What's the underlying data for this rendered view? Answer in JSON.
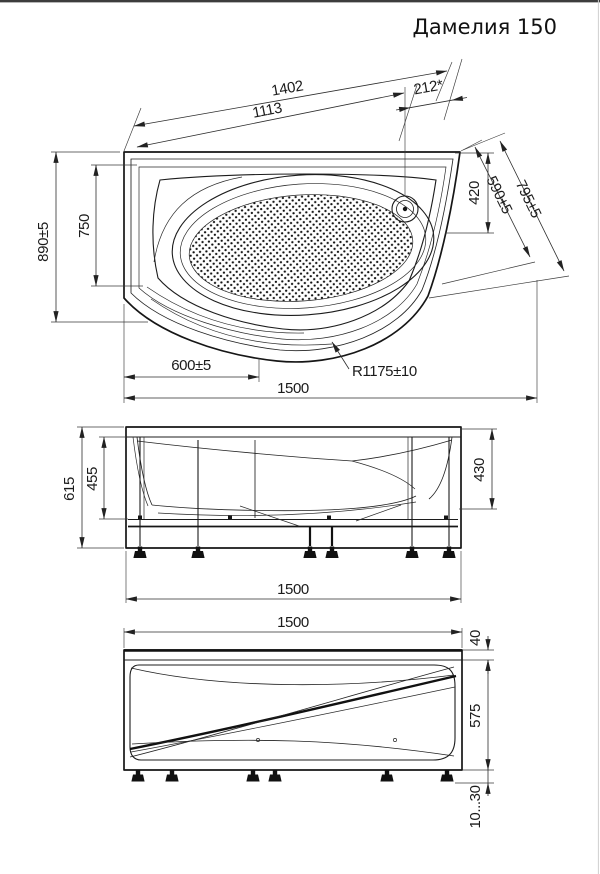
{
  "title": "Дамелия 150",
  "colors": {
    "ink": "#1c1c1c",
    "dim_line": "#2d2d2d",
    "background": "#ffffff",
    "top_border": "#3c3c3c"
  },
  "top_view": {
    "dim_1402": "1402",
    "dim_1113": "1113",
    "dim_212": "212*",
    "dim_420": "420",
    "dim_590": "590±5",
    "dim_795": "795±5",
    "dim_890": "890±5",
    "dim_750": "750",
    "dim_600": "600±5",
    "dim_1500": "1500",
    "radius_r1175": "R1175±10"
  },
  "side_view": {
    "dim_615": "615",
    "dim_455": "455",
    "dim_430": "430",
    "dim_1500": "1500"
  },
  "front_view": {
    "dim_1500": "1500",
    "dim_40": "40",
    "dim_575": "575",
    "dim_feet_gap": "10...30"
  }
}
